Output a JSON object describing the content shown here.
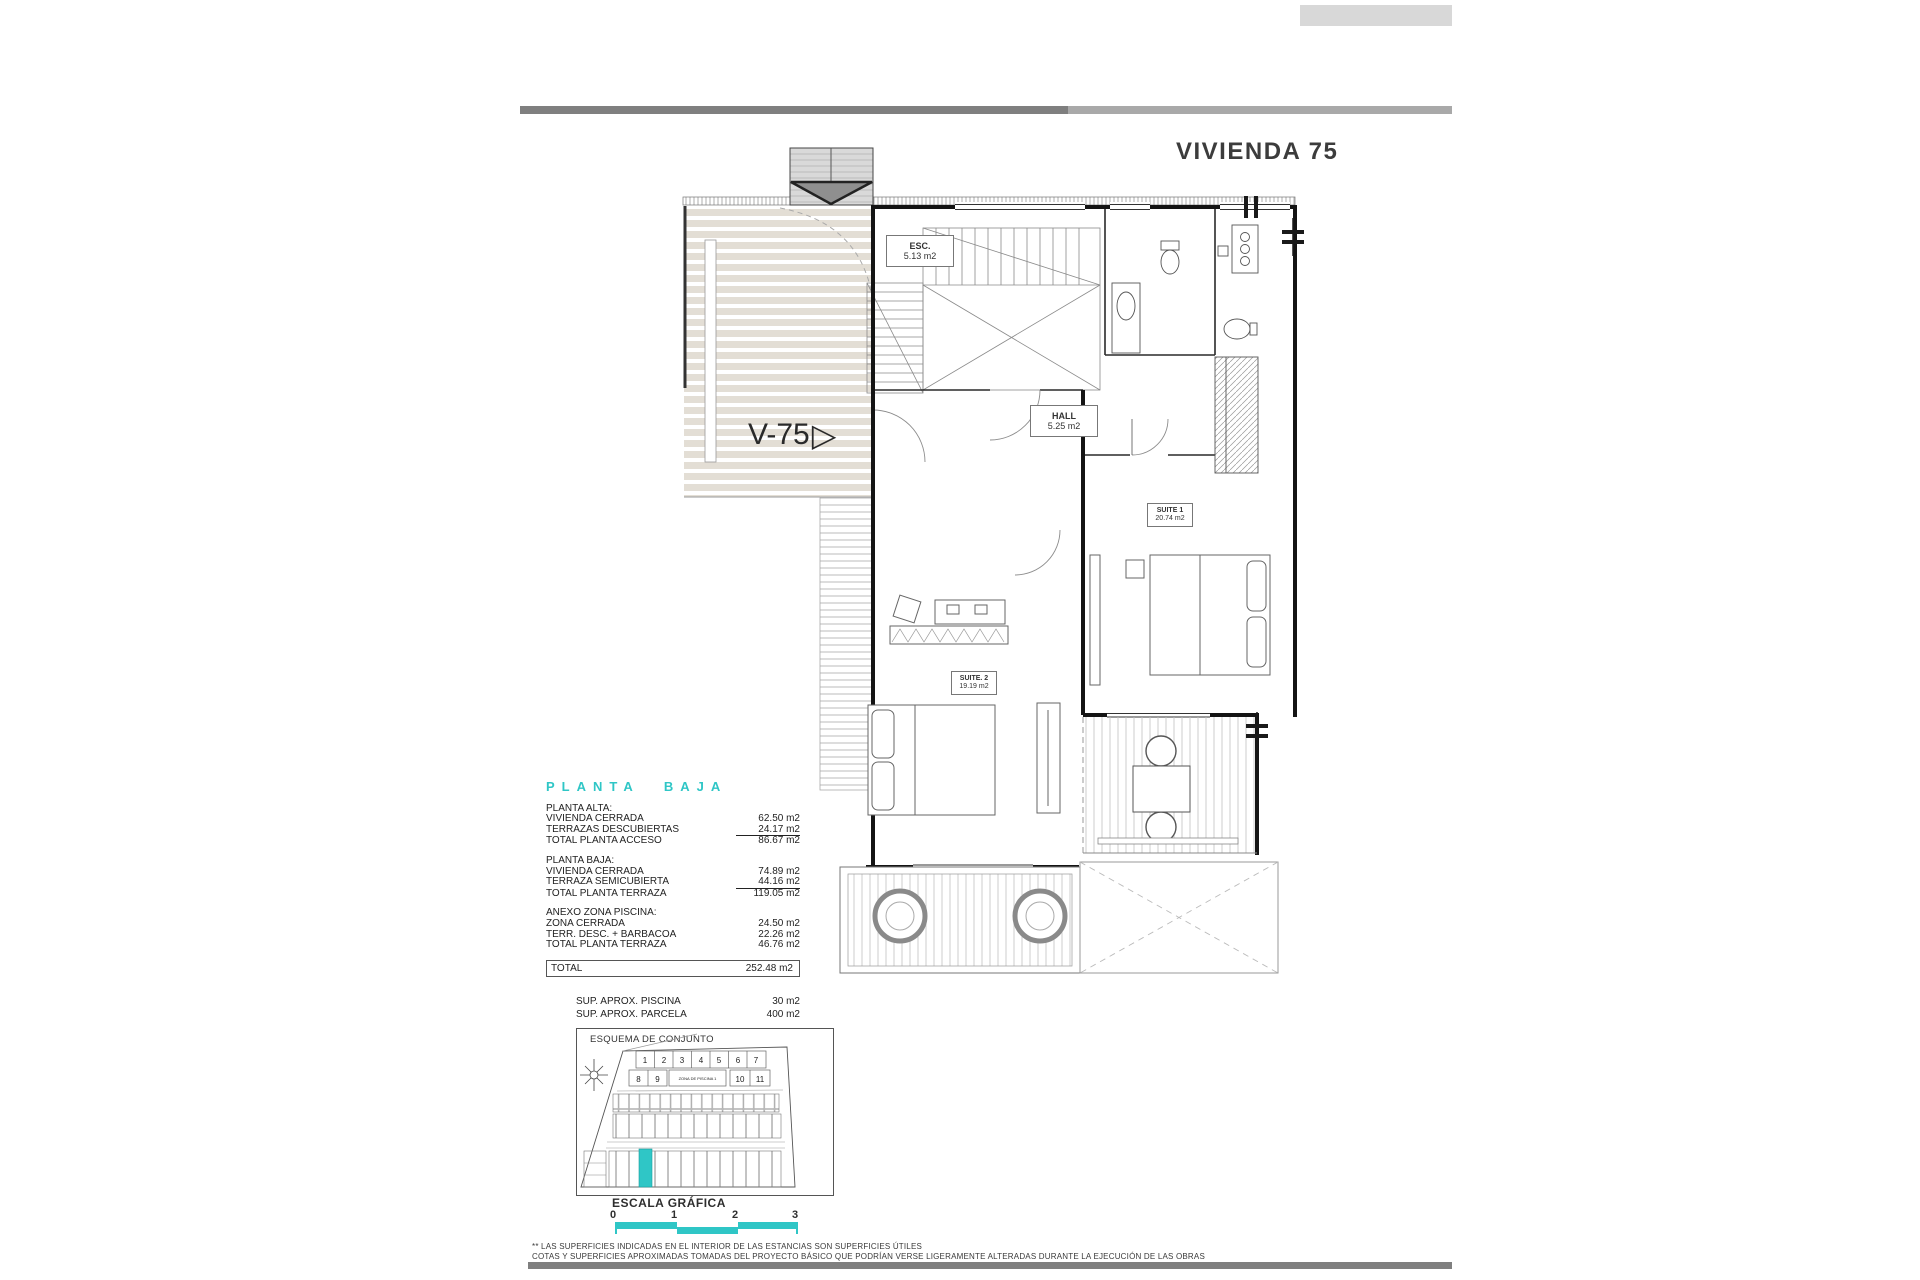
{
  "title": "VIVIENDA 75",
  "colors": {
    "accent": "#2fc6c6",
    "terrace_stripe": "#e3ded5",
    "bar_dark": "#7f7f7f",
    "bar_light": "#a9a9a9"
  },
  "plan": {
    "unit_label": "V-75",
    "rooms": {
      "esc": {
        "name": "ESC.",
        "area": "5.13 m2"
      },
      "hall": {
        "name": "HALL",
        "area": "5.25 m2"
      },
      "suite1": {
        "name": "SUITE 1",
        "area": "20.74 m2"
      },
      "suite2": {
        "name": "SUITE. 2",
        "area": "19.19 m2"
      }
    }
  },
  "surfaces": {
    "heading": "PLANTA BAJA",
    "sections": [
      {
        "title": "PLANTA ALTA:",
        "rows": [
          {
            "label": "VIVIENDA CERRADA",
            "value": "62.50 m2"
          },
          {
            "label": "TERRAZAS DESCUBIERTAS",
            "value": "24.17 m2"
          },
          {
            "label": "TOTAL PLANTA ACCESO",
            "value": "86.67 m2"
          }
        ]
      },
      {
        "title": "PLANTA BAJA:",
        "rows": [
          {
            "label": "VIVIENDA CERRADA",
            "value": "74.89 m2"
          },
          {
            "label": "TERRAZA SEMICUBIERTA",
            "value": "44.16 m2"
          },
          {
            "label": "TOTAL PLANTA TERRAZA",
            "value": "119.05 m2"
          }
        ]
      },
      {
        "title": "ANEXO ZONA PISCINA:",
        "rows": [
          {
            "label": "ZONA CERRADA",
            "value": "24.50 m2"
          },
          {
            "label": "TERR. DESC. + BARBACOA",
            "value": "22.26 m2"
          },
          {
            "label": "TOTAL PLANTA TERRAZA",
            "value": "46.76 m2"
          }
        ]
      }
    ],
    "total": {
      "label": "TOTAL",
      "value": "252.48 m2"
    },
    "extras": [
      {
        "label": "SUP.  APROX. PISCINA",
        "value": "30 m2"
      },
      {
        "label": "SUP.  APROX. PARCELA",
        "value": "400 m2"
      }
    ]
  },
  "site_plan": {
    "title": "ESQUEMA DE CONJUNTO",
    "row1_lots": [
      "1",
      "2",
      "3",
      "4",
      "5",
      "6",
      "7"
    ],
    "row2_left_lots": [
      "8",
      "9"
    ],
    "pool_label": "ZONA DE PISCINA 1",
    "row2_right_lots": [
      "10",
      "11"
    ]
  },
  "scale": {
    "title": "ESCALA GRÁFICA",
    "ticks": [
      "0",
      "1",
      "2",
      "3"
    ]
  },
  "footnotes": {
    "line1": "** LAS SUPERFICIES INDICADAS EN EL INTERIOR DE LAS ESTANCIAS SON SUPERFICIES ÚTILES",
    "line2": "COTAS Y SUPERFICIES APROXIMADAS TOMADAS DEL PROYECTO BÁSICO QUE PODRÍAN VERSE LIGERAMENTE ALTERADAS DURANTE LA EJECUCIÓN DE LAS OBRAS"
  }
}
